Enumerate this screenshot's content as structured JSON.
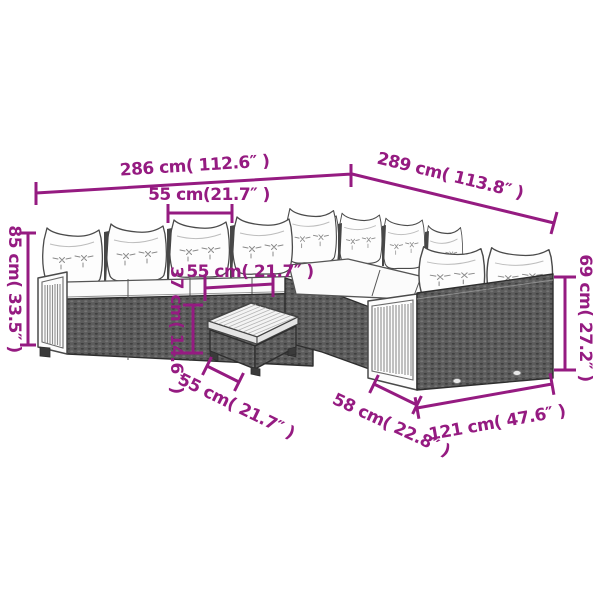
{
  "diagram": {
    "subject": "garden-rattan-sofa-set-with-coffee-table-dimension-drawing",
    "colors": {
      "dimension_accent": "#951B81",
      "line_art": "#4A4A4A",
      "rattan_fill": "#5C5C5C",
      "background": "#FFFFFF"
    },
    "dimensions": {
      "overall_width": {
        "label": "286 cm( 112.6″ )",
        "cm": 286,
        "inches": 112.6
      },
      "overall_depth": {
        "label": "289 cm( 113.8″ )",
        "cm": 289,
        "inches": 113.8
      },
      "seat_module_width": {
        "label": "55 cm(21.7″ )",
        "cm": 55,
        "inches": 21.7
      },
      "total_height": {
        "label": "85 cm( 33.5″ )",
        "cm": 85,
        "inches": 33.5
      },
      "table_width": {
        "label": "55 cm( 21.7″ )",
        "cm": 55,
        "inches": 21.7
      },
      "table_height": {
        "label": "37 cm( 14.6″ )",
        "cm": 37,
        "inches": 14.6
      },
      "table_depth": {
        "label": "55 cm( 21.7″ )",
        "cm": 55,
        "inches": 21.7
      },
      "right_sofa_depth": {
        "label": "58 cm( 22.8″ )",
        "cm": 58,
        "inches": 22.8
      },
      "right_sofa_width": {
        "label": "121 cm( 47.6″ )",
        "cm": 121,
        "inches": 47.6
      },
      "right_backrest_height": {
        "label": "69 cm( 27.2″ )",
        "cm": 69,
        "inches": 27.2
      }
    }
  }
}
